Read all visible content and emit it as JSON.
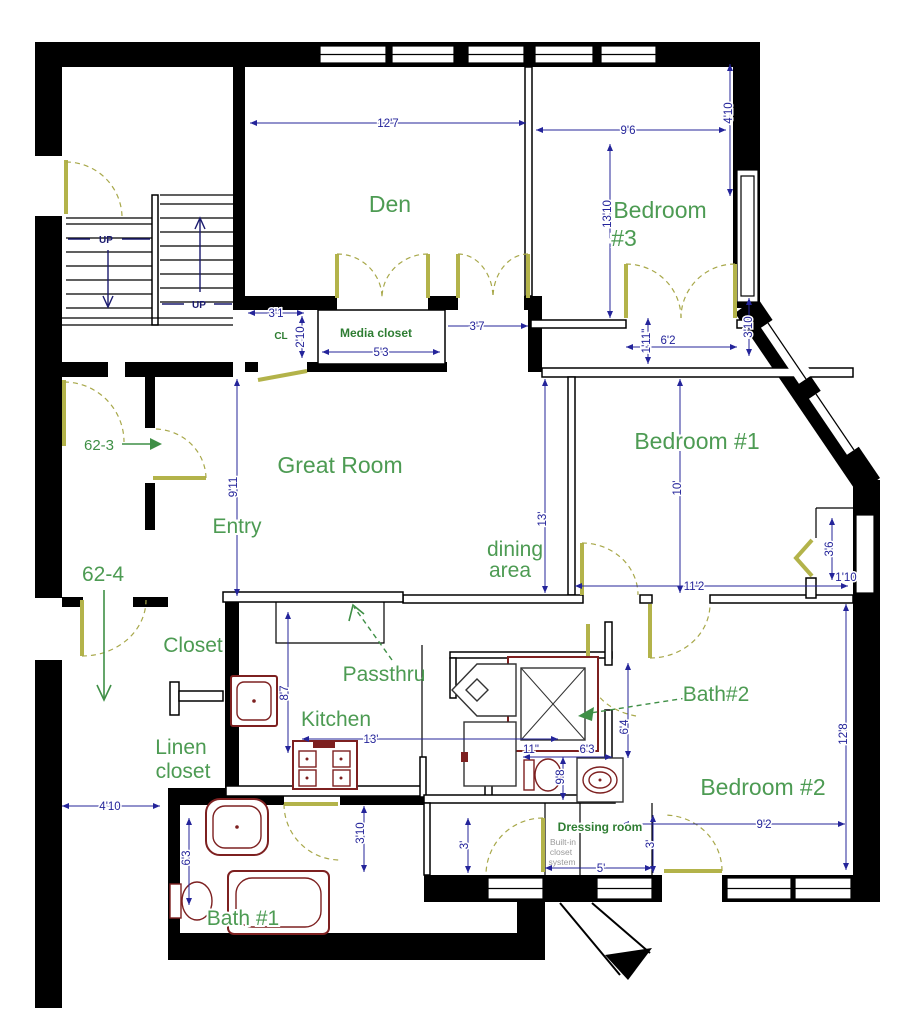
{
  "colors": {
    "label_green": "#4d9b53",
    "small_label_green": "#2e7d32",
    "dimension_navy": "#24249a",
    "door_olive": "#b3b34a",
    "fixture_maroon": "#7d2020",
    "wall_black": "#000000",
    "gray_text": "#9a9a9a"
  },
  "labels": {
    "den": "Den",
    "bedroom3_l1": "Bedroom",
    "bedroom3_l2": "#3",
    "bedroom1": "Bedroom #1",
    "bedroom2": "Bedroom #2",
    "great_room": "Great Room",
    "entry": "Entry",
    "dining_l1": "dining",
    "dining_l2": "area",
    "closet": "Closet",
    "passthru": "Passthru",
    "kitchen": "Kitchen",
    "bath1": "Bath #1",
    "bath2": "Bath#2",
    "linen_l1": "Linen",
    "linen_l2": "closet",
    "media_closet": "Media closet",
    "dressing_room": "Dressing room",
    "cl": "CL",
    "builtin_l1": "Built-in",
    "builtin_l2": "closet",
    "builtin_l3": "system"
  },
  "annotations": {
    "unit_62_3": "62-3",
    "unit_62_4": "62-4",
    "up_left": "UP",
    "up_right": "UP"
  },
  "dimensions": {
    "den_width": "12'7",
    "bed3_width": "9'6",
    "bed3_side": "4'10",
    "bed3_height": "13'10",
    "bed3_window": "3'10",
    "cl_width": "3'1",
    "cl_depth": "2'10",
    "media_width": "5'3",
    "hall_opening": "3'7",
    "bed3_jamb": "1'11\"",
    "bed3_door": "6'2",
    "entry_height": "9'11",
    "dining_depth": "13'",
    "bed1_depth": "10'",
    "bed1_width": "11'2",
    "bed1_closet_depth": "3'6",
    "bed1_closet_width": "1'10",
    "bed2_depth": "12'8",
    "bed2_width": "9'2",
    "kitchen_depth": "8'7",
    "kitchen_width": "13'",
    "bath2_depth": "6'4",
    "bath2_width": "6'3",
    "toilet_width": "11\"",
    "bath2_height": "9'8",
    "hall_width": "4'10",
    "bath1_depth": "6'3",
    "bath1_door": "3'10",
    "dress_left": "3'",
    "dress_right": "3'",
    "dress_width": "5'"
  }
}
